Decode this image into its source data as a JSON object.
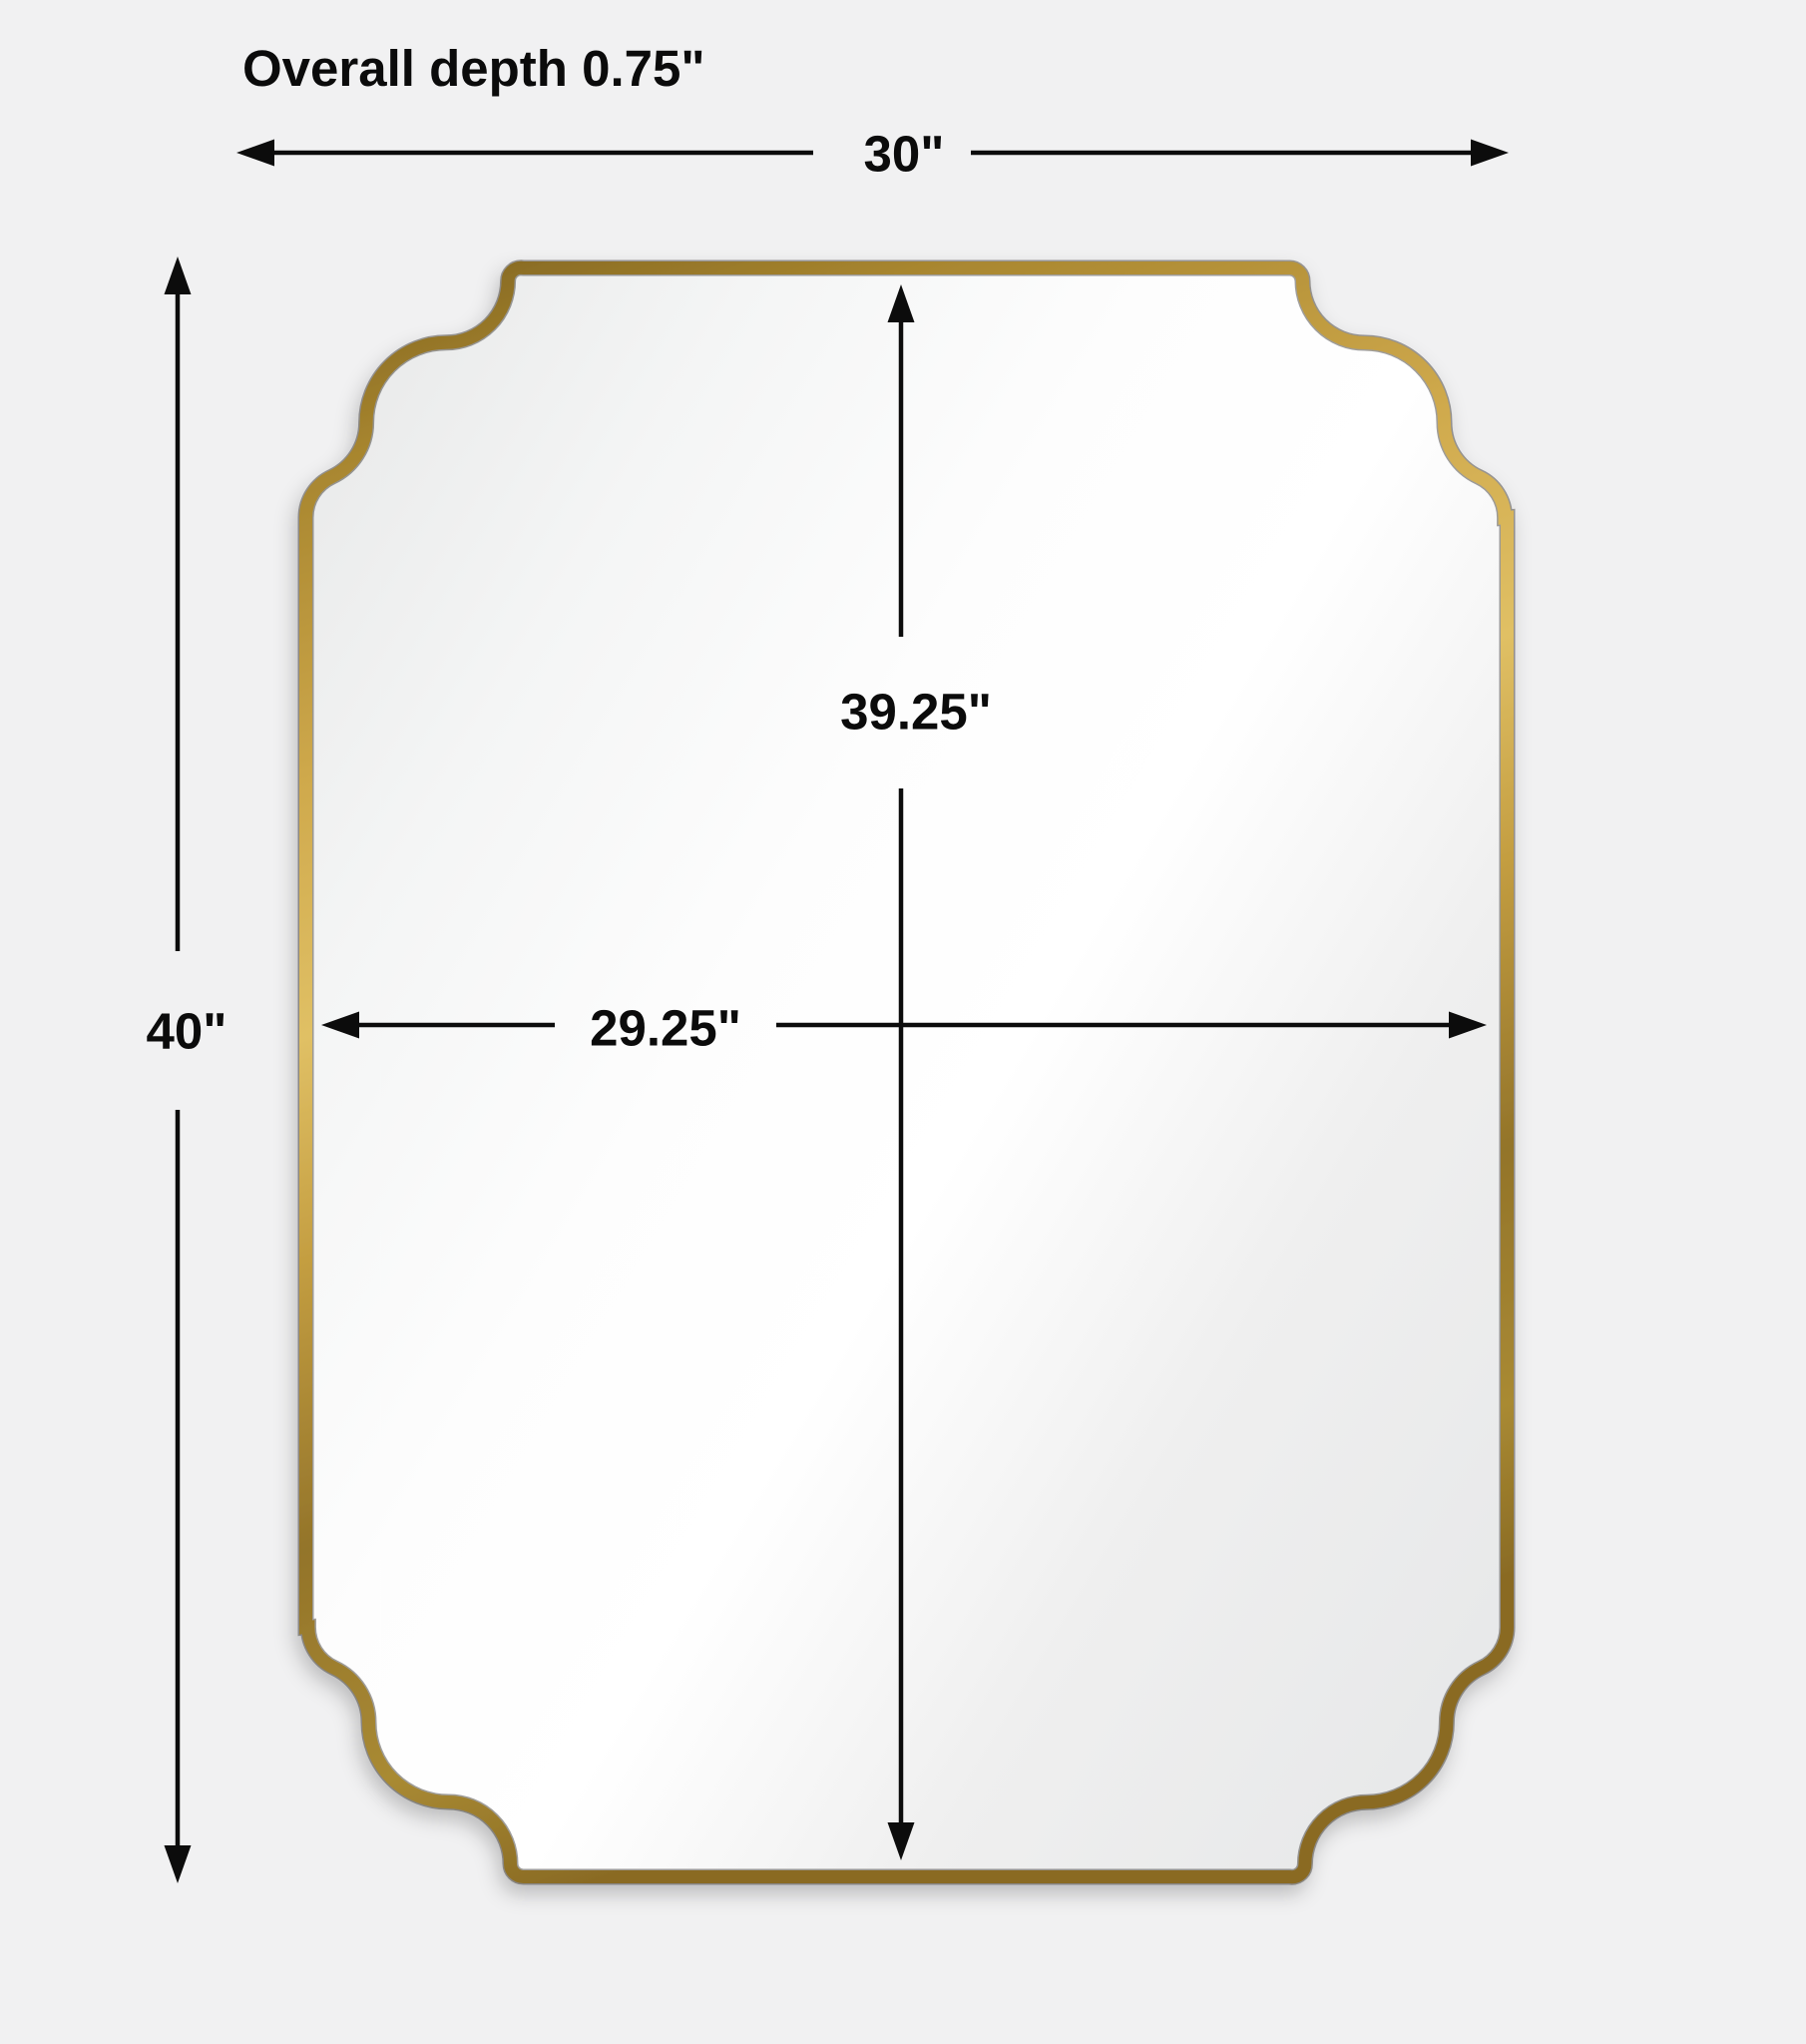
{
  "title": "Overall depth 0.75\"",
  "dimensions": {
    "overall_width": "30\"",
    "overall_height": "40\"",
    "mirror_height": "39.25\"",
    "mirror_width": "29.25\""
  },
  "colors": {
    "background": "#f1f1f2",
    "dimension_line": "#0c0c0c",
    "frame_gold": "#c29c42",
    "mirror_face": "#f7f8f8"
  }
}
